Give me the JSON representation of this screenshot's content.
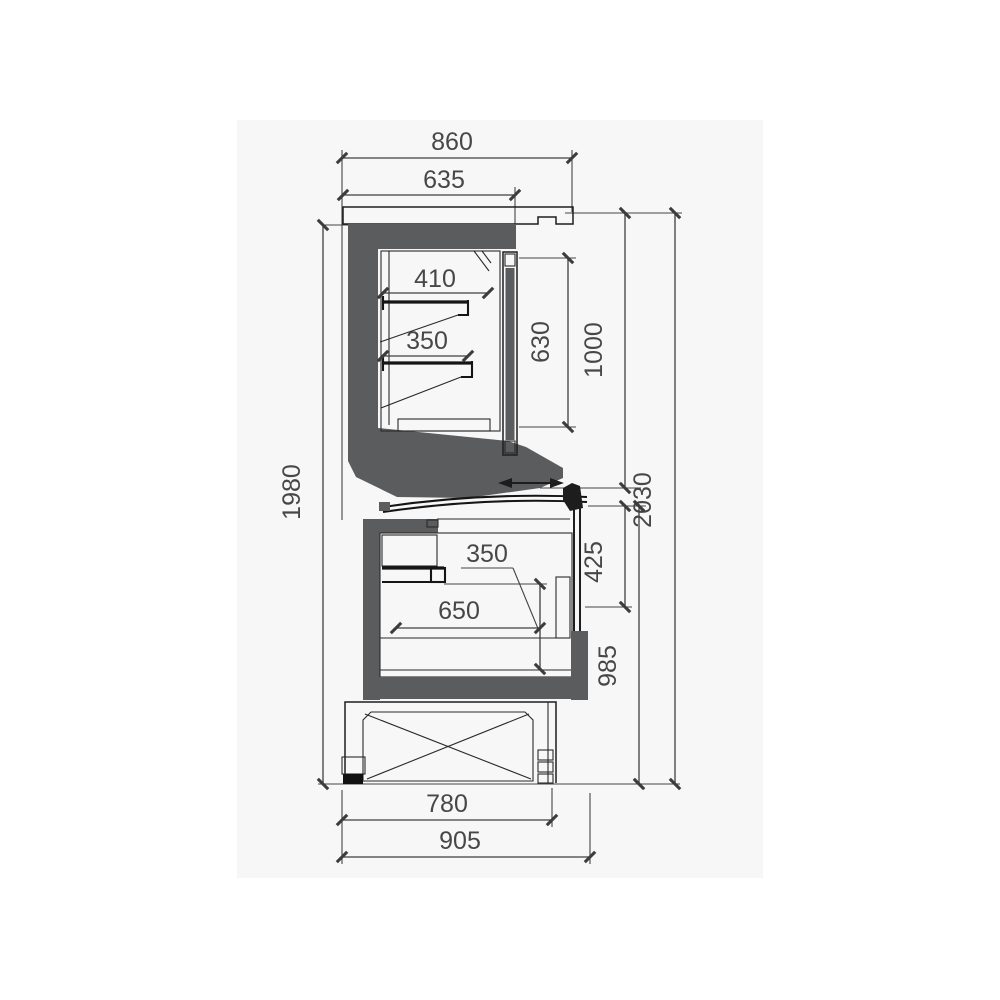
{
  "meta": {
    "type": "technical-dimension-drawing",
    "subject": "Refrigerated display counter - side cross-section with dimensions",
    "units": "mm"
  },
  "colors": {
    "page_bg": "#ffffff",
    "canvas_bg": "#f7f7f7",
    "frame_fill": "#5b5c5e",
    "outline": "#1d1d1d",
    "dim_line": "#3f3f3f",
    "dim_text": "#474747",
    "foot_fill": "#111111"
  },
  "dimensions": {
    "top_overall_width": "860",
    "top_body_width": "635",
    "upper_shelf_depth": "410",
    "upper_second_shelf_depth": "350",
    "door_glass_height": "630",
    "upper_section_height": "1000",
    "overall_height": "2030",
    "rear_height": "1980",
    "well_inner_depth": "350",
    "well_inner_width": "650",
    "glass_end_height": "425",
    "lower_section_height": "985",
    "base_frame_width": "780",
    "lower_overall_width": "905"
  },
  "icons": {
    "slide_direction": "double-headed horizontal arrow (sliding lid)"
  }
}
